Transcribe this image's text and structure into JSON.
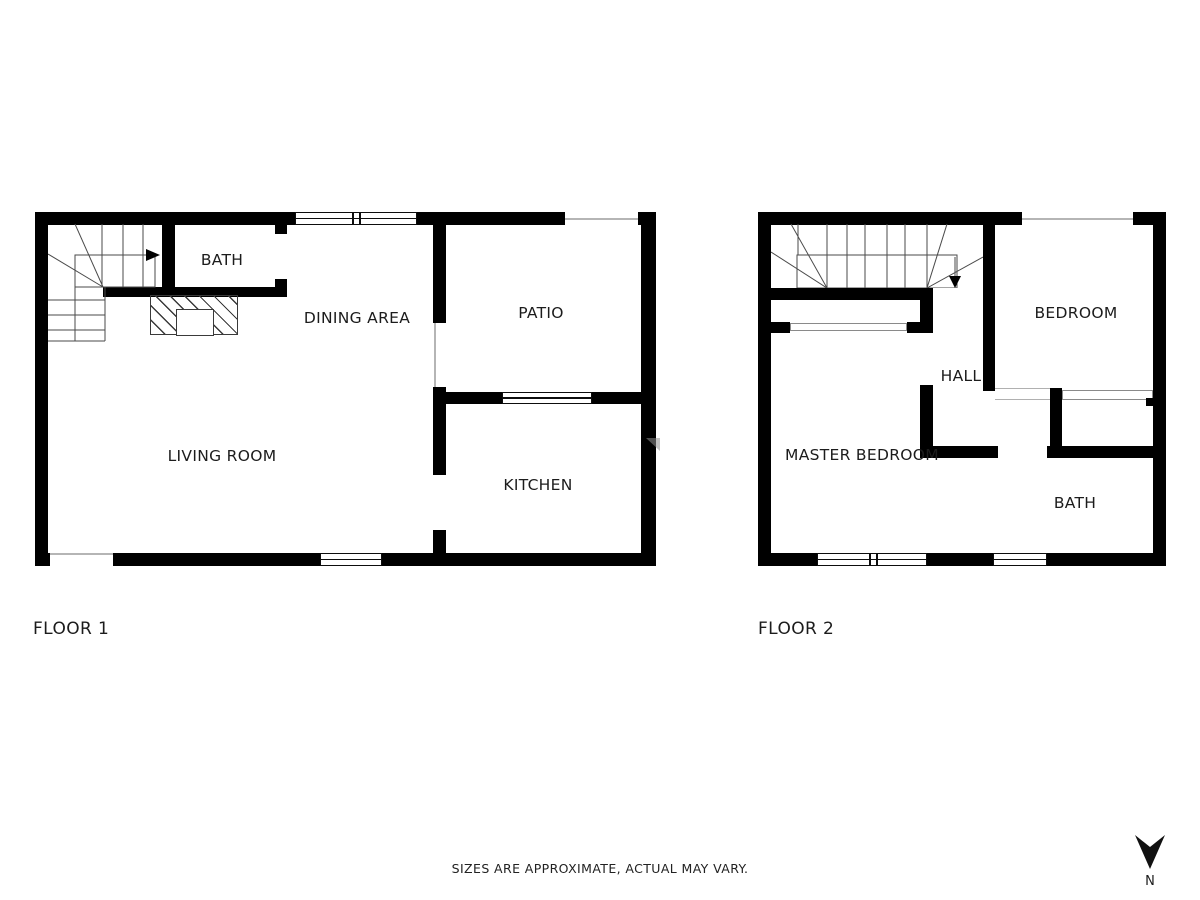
{
  "colors": {
    "wall": "#000000",
    "stair_line": "#4a4a4a",
    "opening_line": "#b5b5b5",
    "text": "#1c1c1c",
    "background": "#ffffff"
  },
  "floor1": {
    "title": "FLOOR 1",
    "rooms": {
      "bath": "BATH",
      "dining_area": "DINING AREA",
      "patio": "PATIO",
      "living_room": "LIVING ROOM",
      "kitchen": "KITCHEN"
    }
  },
  "floor2": {
    "title": "FLOOR 2",
    "rooms": {
      "bedroom": "BEDROOM",
      "hall": "HALL",
      "master_bedroom": "MASTER BEDROOM",
      "bath": "BATH"
    }
  },
  "footer": {
    "disclaimer": "SIZES ARE APPROXIMATE, ACTUAL MAY VARY."
  },
  "compass": {
    "label": "N"
  }
}
